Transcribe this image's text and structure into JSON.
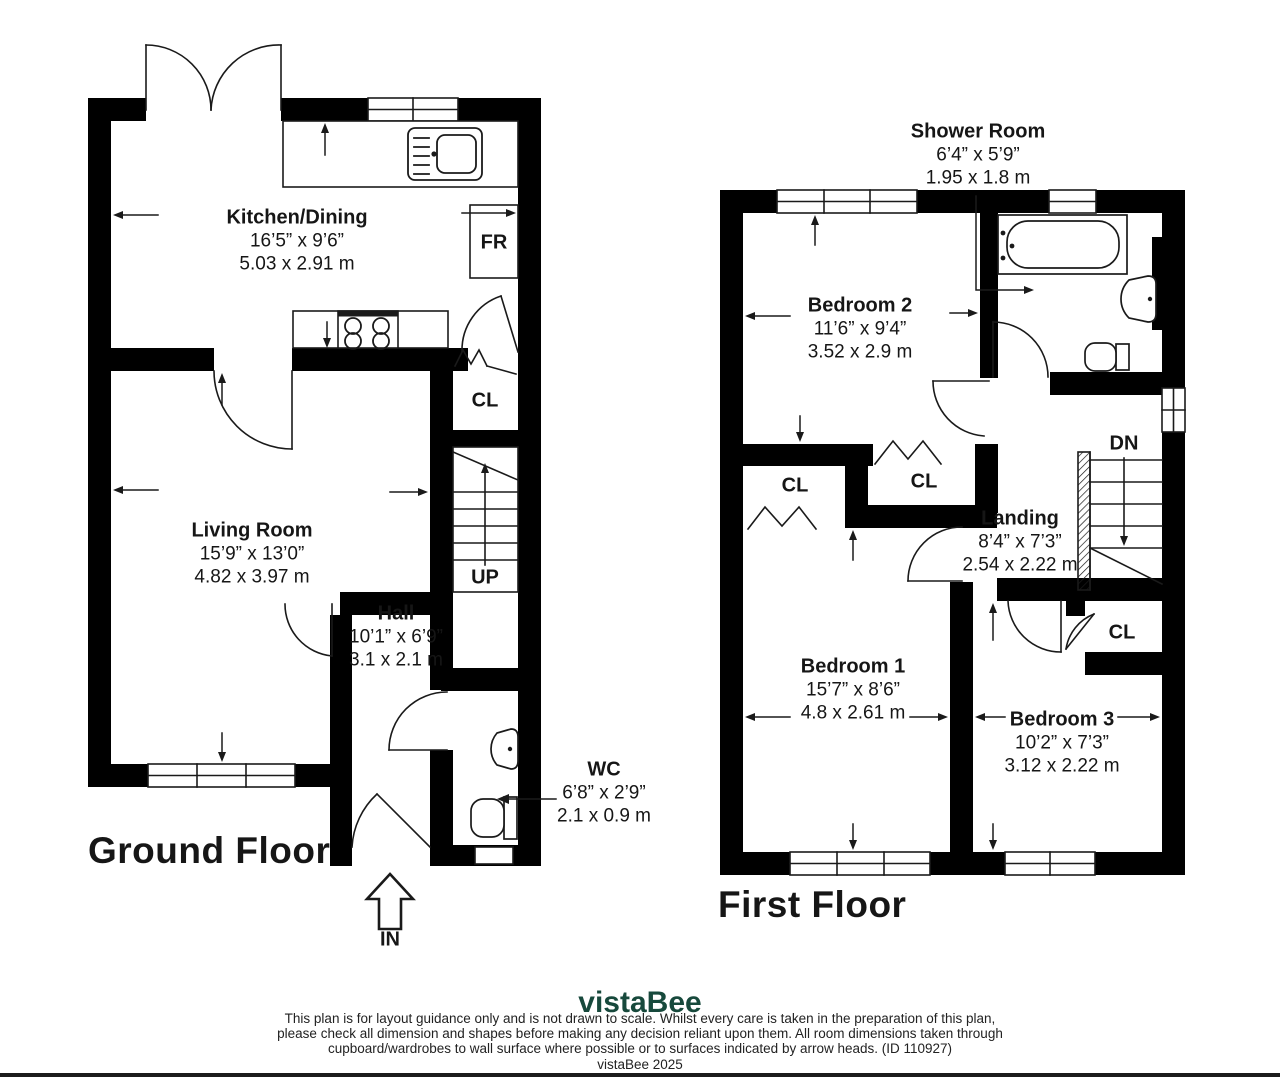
{
  "ground_floor": {
    "title": "Ground Floor",
    "rooms": {
      "kitchen": {
        "name": "Kitchen/Dining",
        "imperial": "16’5” x 9’6”",
        "metric": "5.03 x 2.91 m"
      },
      "living": {
        "name": "Living Room",
        "imperial": "15’9” x 13’0”",
        "metric": "4.82 x 3.97 m"
      },
      "hall": {
        "name": "Hall",
        "imperial": "10’1” x 6’9”",
        "metric": "3.1 x 2.1 m"
      },
      "wc": {
        "name": "WC",
        "imperial": "6’8” x 2’9”",
        "metric": "2.1 x 0.9 m"
      }
    },
    "labels": {
      "closet": "CL",
      "fridge": "FR",
      "stairs_up": "UP",
      "entrance": "IN"
    }
  },
  "first_floor": {
    "title": "First Floor",
    "rooms": {
      "shower": {
        "name": "Shower Room",
        "imperial": "6’4” x 5’9”",
        "metric": "1.95 x 1.8 m"
      },
      "bedroom2": {
        "name": "Bedroom 2",
        "imperial": "11’6” x 9’4”",
        "metric": "3.52 x 2.9 m"
      },
      "landing": {
        "name": "Landing",
        "imperial": "8’4” x 7’3”",
        "metric": "2.54 x 2.22 m"
      },
      "bedroom1": {
        "name": "Bedroom 1",
        "imperial": "15’7” x 8’6”",
        "metric": "4.8 x 2.61 m"
      },
      "bedroom3": {
        "name": "Bedroom 3",
        "imperial": "10’2” x 7’3”",
        "metric": "3.12 x 2.22 m"
      }
    },
    "labels": {
      "closet_b1": "CL",
      "closet_mid": "CL",
      "closet_b3": "CL",
      "stairs_down": "DN"
    }
  },
  "footer": {
    "logo": "vistaBee",
    "logo_color": "#17493c",
    "disclaimer_line1": "This plan is for layout guidance only and is not drawn to scale. Whilst every care is taken in the preparation of this plan,",
    "disclaimer_line2": "please check all dimension and shapes before making any decision reliant upon them. All room dimensions taken through",
    "disclaimer_line3": "cupboard/wardrobes to wall surface where possible or to surfaces indicated by arrow heads. (ID 110927)",
    "copyright": "vistaBee 2025"
  }
}
